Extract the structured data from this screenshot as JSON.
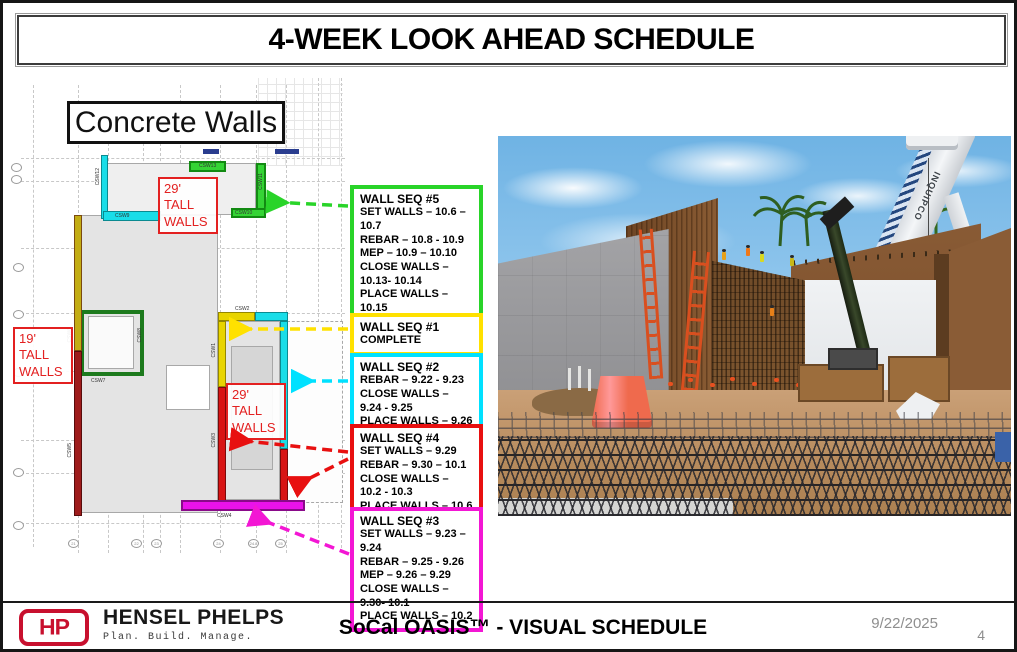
{
  "title": "4-WEEK LOOK AHEAD SCHEDULE",
  "plan": {
    "heading": "Concrete Walls",
    "labels": {
      "tall29_top": "29' TALL WALLS",
      "tall29_mid": "29' TALL WALLS",
      "tall19": "19' TALL WALLS"
    },
    "tags": {
      "csw1": "CSW1",
      "csw2": "CSW2",
      "csw3": "CSW3",
      "csw4": "CSW4",
      "csw5": "CSW5",
      "csw6": "CSW6",
      "csw7": "CSW7",
      "csw8": "CSW8",
      "csw9": "CSW9",
      "csw10": "CSW10",
      "csw11": "CSW11",
      "csw12": "CSW12",
      "csw13": "CSW13"
    },
    "grid_bottom": [
      "21",
      "22",
      "23",
      "24",
      "24.8",
      "25"
    ]
  },
  "callouts": [
    {
      "title": "WALL SEQ #5",
      "lines": [
        "SET WALLS – 10.6 – 10.7",
        "REBAR – 10.8 - 10.9",
        "MEP – 10.9 – 10.10",
        "CLOSE WALLS – 10.13- 10.14",
        "PLACE WALLS – 10.15"
      ]
    },
    {
      "title": "WALL SEQ #1",
      "lines": [
        "COMPLETE"
      ]
    },
    {
      "title": "WALL SEQ #2",
      "lines": [
        "REBAR – 9.22 - 9.23",
        "CLOSE WALLS – 9.24 - 9.25",
        "PLACE WALLS – 9.26"
      ]
    },
    {
      "title": "WALL SEQ #4",
      "lines": [
        "SET WALLS – 9.29",
        "REBAR – 9.30 – 10.1",
        "CLOSE WALLS – 10.2 - 10.3",
        "PLACE WALLS – 10.6"
      ]
    },
    {
      "title": "WALL SEQ #3",
      "lines": [
        "SET WALLS – 9.23 – 9.24",
        "REBAR – 9.25 - 9.26",
        "MEP – 9.26 – 9.29",
        "CLOSE WALLS – 9.30- 10.1",
        "PLACE WALLS – 10.2"
      ]
    }
  ],
  "colors": {
    "seq5": "#29d429",
    "seq1": "#ffe100",
    "seq2": "#00e1ff",
    "seq4": "#e81010",
    "seq3": "#f316d4",
    "wall_green": "#35d435",
    "wall_cyan": "#19dde8",
    "wall_yellow": "#e8d400",
    "wall_red": "#d81414",
    "wall_darkred": "#9e1c1c",
    "wall_magenta": "#ea12ea",
    "label_red": "#e32020",
    "brand_red": "#c8102e"
  },
  "photo": {
    "crane_text": "INQUIPCO"
  },
  "footer": {
    "logo_monogram": "HP",
    "company": "HENSEL PHELPS",
    "tagline": "Plan. Build. Manage.",
    "subtitle": "SoCal OASIS™ - VISUAL SCHEDULE",
    "date": "9/22/2025",
    "page": "4"
  }
}
